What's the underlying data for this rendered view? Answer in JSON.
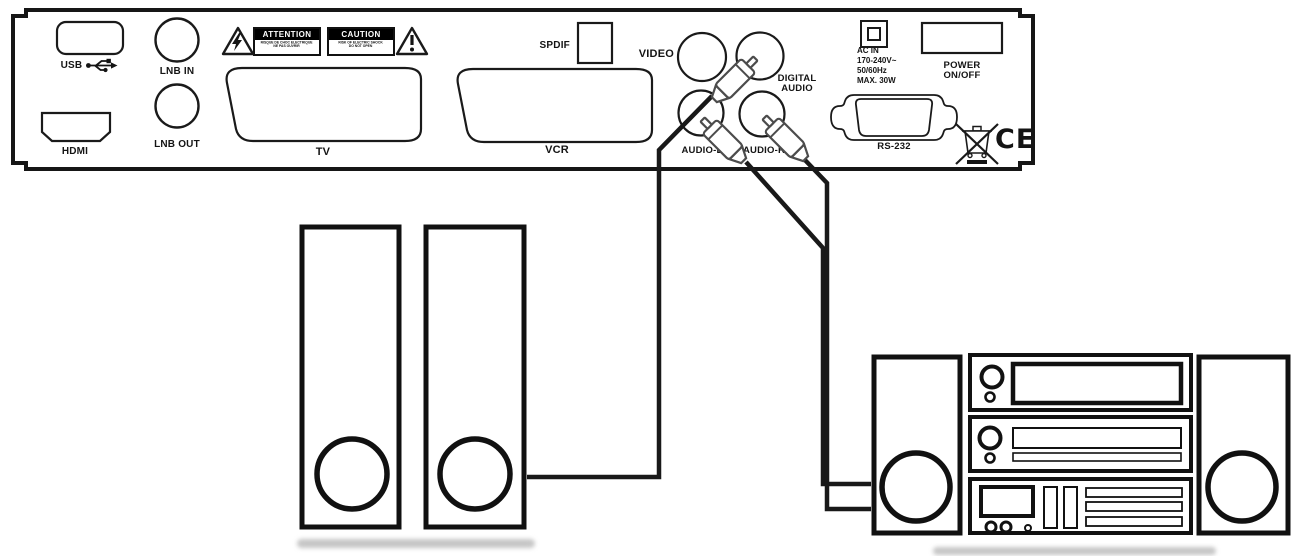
{
  "panel": {
    "ports": {
      "usb": "USB",
      "hdmi": "HDMI",
      "lnb_in": "LNB IN",
      "lnb_out": "LNB OUT",
      "tv": "TV",
      "vcr": "VCR",
      "spdif": "SPDIF",
      "video": "VIDEO",
      "digital_audio_line1": "DIGITAL",
      "digital_audio_line2": "AUDIO",
      "audio_left": "AUDIO-L",
      "audio_right": "AUDIO-R",
      "rs232": "RS-232"
    },
    "power": {
      "ac_line1": "AC IN",
      "ac_line2": "170-240V~",
      "ac_line3": "50/60Hz",
      "ac_line4": "MAX. 30W",
      "switch_line1": "POWER",
      "switch_line2": "ON/OFF"
    },
    "warnings": {
      "attention": {
        "title": "ATTENTION",
        "line1": "RISQUE DE CHOC ELECTRIQUE",
        "line2": "NE PAS OUVRIR"
      },
      "caution": {
        "title": "CAUTION",
        "line1": "RISK OF ELECTRIC SHOCK",
        "line2": "DO NOT OPEN"
      }
    },
    "marks": {
      "ce": "CE"
    }
  },
  "icons": {
    "usb_symbol": "usb-trident-icon",
    "lightning_triangle": "electric-shock-warning-icon",
    "exclamation_triangle": "general-warning-icon",
    "weee": "crossed-out-wheeled-bin-icon"
  },
  "colors": {
    "outline": "#1a1a1a",
    "background": "#ffffff",
    "warning_bg": "#000000",
    "warning_text": "#ffffff",
    "shadow": "#c6c6c6"
  }
}
